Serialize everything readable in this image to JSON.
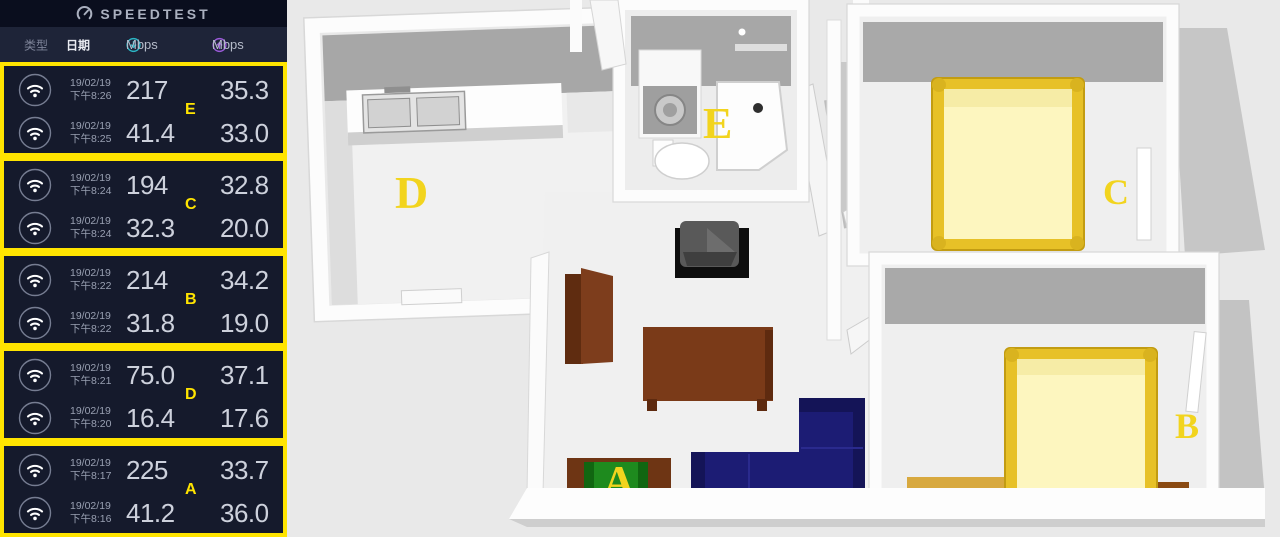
{
  "app": {
    "title": "SPEEDTEST"
  },
  "columns": {
    "type": "类型",
    "date": "日期",
    "download_unit": "Mbps",
    "upload_unit": "Mbps"
  },
  "groups": [
    {
      "label": "E",
      "rows": [
        {
          "date": "19/02/19",
          "time": "下午8:26",
          "down": "217",
          "up": "35.3"
        },
        {
          "date": "19/02/19",
          "time": "下午8:25",
          "down": "41.4",
          "up": "33.0"
        }
      ]
    },
    {
      "label": "C",
      "rows": [
        {
          "date": "19/02/19",
          "time": "下午8:24",
          "down": "194",
          "up": "32.8"
        },
        {
          "date": "19/02/19",
          "time": "下午8:24",
          "down": "32.3",
          "up": "20.0"
        }
      ]
    },
    {
      "label": "B",
      "rows": [
        {
          "date": "19/02/19",
          "time": "下午8:22",
          "down": "214",
          "up": "34.2"
        },
        {
          "date": "19/02/19",
          "time": "下午8:22",
          "down": "31.8",
          "up": "19.0"
        }
      ]
    },
    {
      "label": "D",
      "rows": [
        {
          "date": "19/02/19",
          "time": "下午8:21",
          "down": "75.0",
          "up": "37.1"
        },
        {
          "date": "19/02/19",
          "time": "下午8:20",
          "down": "16.4",
          "up": "17.6"
        }
      ]
    },
    {
      "label": "A",
      "rows": [
        {
          "date": "19/02/19",
          "time": "下午8:17",
          "down": "225",
          "up": "33.7"
        },
        {
          "date": "19/02/19",
          "time": "下午8:16",
          "down": "41.2",
          "up": "36.0"
        }
      ]
    }
  ],
  "floorplan": {
    "labels": {
      "kitchen": "D",
      "bathroom": "E",
      "bedroom_top": "C",
      "bedroom_bottom": "B",
      "tv_area": "A"
    }
  },
  "colors": {
    "accent_yellow": "#ffe400",
    "download_teal": "#2bb5c4",
    "upload_purple": "#9a5ad8",
    "bed_frame": "#e7c127",
    "bed_mattress": "#fdf6bf",
    "sofa_navy": "#1c1c74",
    "table_brown": "#7a3a18",
    "tv_green": "#1e8a1e"
  }
}
